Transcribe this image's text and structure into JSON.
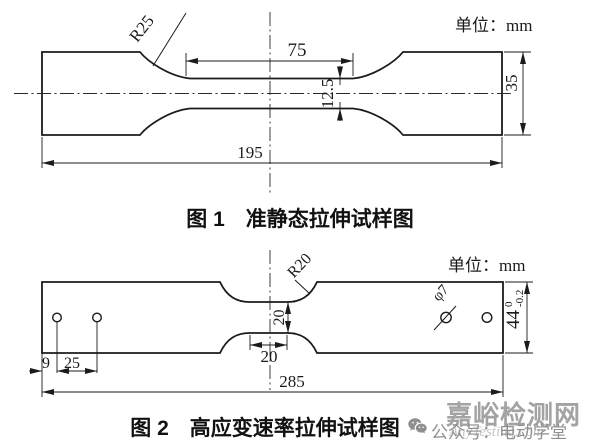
{
  "figure1": {
    "unit_label": "单位：mm",
    "caption": "图 1　准静态拉伸试样图",
    "dims": {
      "fillet_radius": "R25",
      "gauge_length": "75",
      "gauge_width": "12.5",
      "grip_width": "35",
      "total_length": "195"
    }
  },
  "figure2": {
    "unit_label": "单位：mm",
    "caption": "图 2　高应变速率拉伸试样图",
    "dims": {
      "fillet_radius": "R20",
      "gauge_width": "20",
      "gauge_length": "20",
      "hole_edge_offset": "9",
      "hole_spacing": "25",
      "total_length": "285",
      "hole_diameter": "φ7",
      "width_nominal": "44",
      "width_tol_upper": "0",
      "width_tol_lower": "-0.2"
    }
  },
  "watermark": {
    "site": "嘉峪检测网",
    "account": "公众号：电动学堂",
    "overlay": "AnyTesting.com"
  }
}
